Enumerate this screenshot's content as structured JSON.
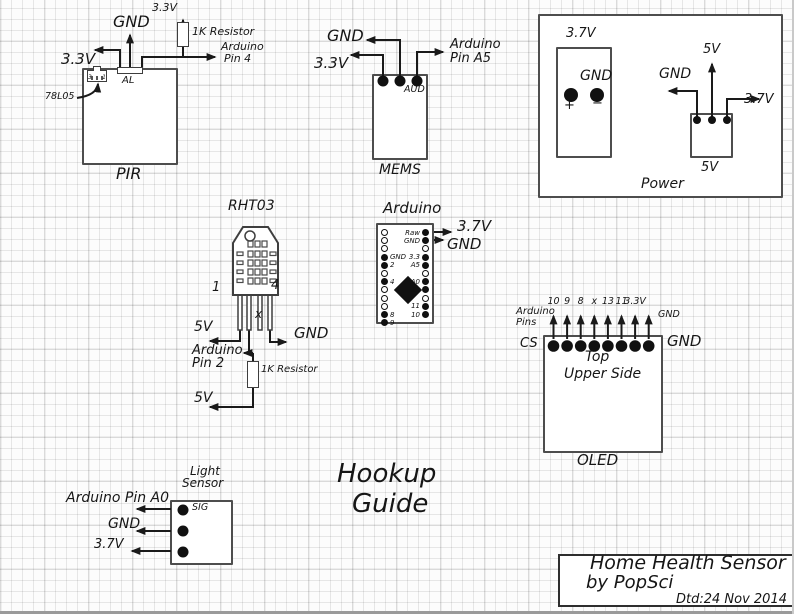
{
  "heading": {
    "line1": "Hookup",
    "line2": "Guide"
  },
  "title_block": {
    "line1": "Home Health Sensor",
    "line2": "by PopSci",
    "date": "Dtd:24 Nov 2014"
  },
  "pir": {
    "name": "PIR",
    "gnd": "GND",
    "v33_left": "3.3V",
    "v33_top": "3.3V",
    "resistor": "1K Resistor",
    "pin_line1": "Arduino",
    "pin_line2": "Pin 4",
    "connector": "AL",
    "regulator": "78L05",
    "reg_pin_left": "3",
    "reg_pin_right": "1"
  },
  "mems": {
    "name": "MEMS",
    "gnd": "GND",
    "v33": "3.3V",
    "pin_line1": "Arduino",
    "pin_line2": "Pin A5",
    "aud": "AUD"
  },
  "power": {
    "name": "Power",
    "battery_v": "3.7V",
    "battery_gnd": "GND",
    "plus": "+",
    "minus": "−",
    "charger_v": "5V",
    "out_gnd": "GND",
    "out_5v": "5V",
    "out_37v": "3.7V"
  },
  "rht03": {
    "name": "RHT03",
    "pin1": "1",
    "pin4": "4",
    "nc_mark": "x",
    "v5_top": "5V",
    "pin_line1": "Arduino",
    "pin_line2": "Pin 2",
    "gnd": "GND",
    "resistor": "1K Resistor",
    "v5_bottom": "5V"
  },
  "arduino": {
    "name": "Arduino",
    "v37": "3.7V",
    "gnd": "GND",
    "left_pins": [
      {
        "label": "",
        "filled": false
      },
      {
        "label": "",
        "filled": false
      },
      {
        "label": "",
        "filled": false
      },
      {
        "label": "GND",
        "filled": true
      },
      {
        "label": "2",
        "filled": true
      },
      {
        "label": "",
        "filled": false
      },
      {
        "label": "4",
        "filled": true
      },
      {
        "label": "",
        "filled": false
      },
      {
        "label": "",
        "filled": false
      },
      {
        "label": "",
        "filled": false
      },
      {
        "label": "8",
        "filled": true
      },
      {
        "label": "9",
        "filled": true
      }
    ],
    "right_pins": [
      {
        "label": "Raw",
        "filled": true
      },
      {
        "label": "GND",
        "filled": true
      },
      {
        "label": "",
        "filled": false
      },
      {
        "label": "3.3",
        "filled": true
      },
      {
        "label": "A5",
        "filled": true
      },
      {
        "label": "",
        "filled": false
      },
      {
        "label": "A0",
        "filled": true
      },
      {
        "label": "13",
        "filled": true
      },
      {
        "label": "",
        "filled": false
      },
      {
        "label": "11",
        "filled": true
      },
      {
        "label": "10",
        "filled": true
      }
    ]
  },
  "oled": {
    "name": "OLED",
    "pins_caption_line1": "Arduino",
    "pins_caption_line2": "Pins",
    "cs": "CS",
    "gnd_right": "GND",
    "gnd_top": "GND",
    "line1": "Top",
    "line2": "Upper Side",
    "pin_labels": [
      "10",
      "9",
      "8",
      "x",
      "13",
      "11",
      "3.3V"
    ]
  },
  "light_sensor": {
    "name_line1": "Light",
    "name_line2": "Sensor",
    "sig": "SIG",
    "pin_a0": "Arduino Pin A0",
    "gnd": "GND",
    "v37": "3.7V"
  }
}
